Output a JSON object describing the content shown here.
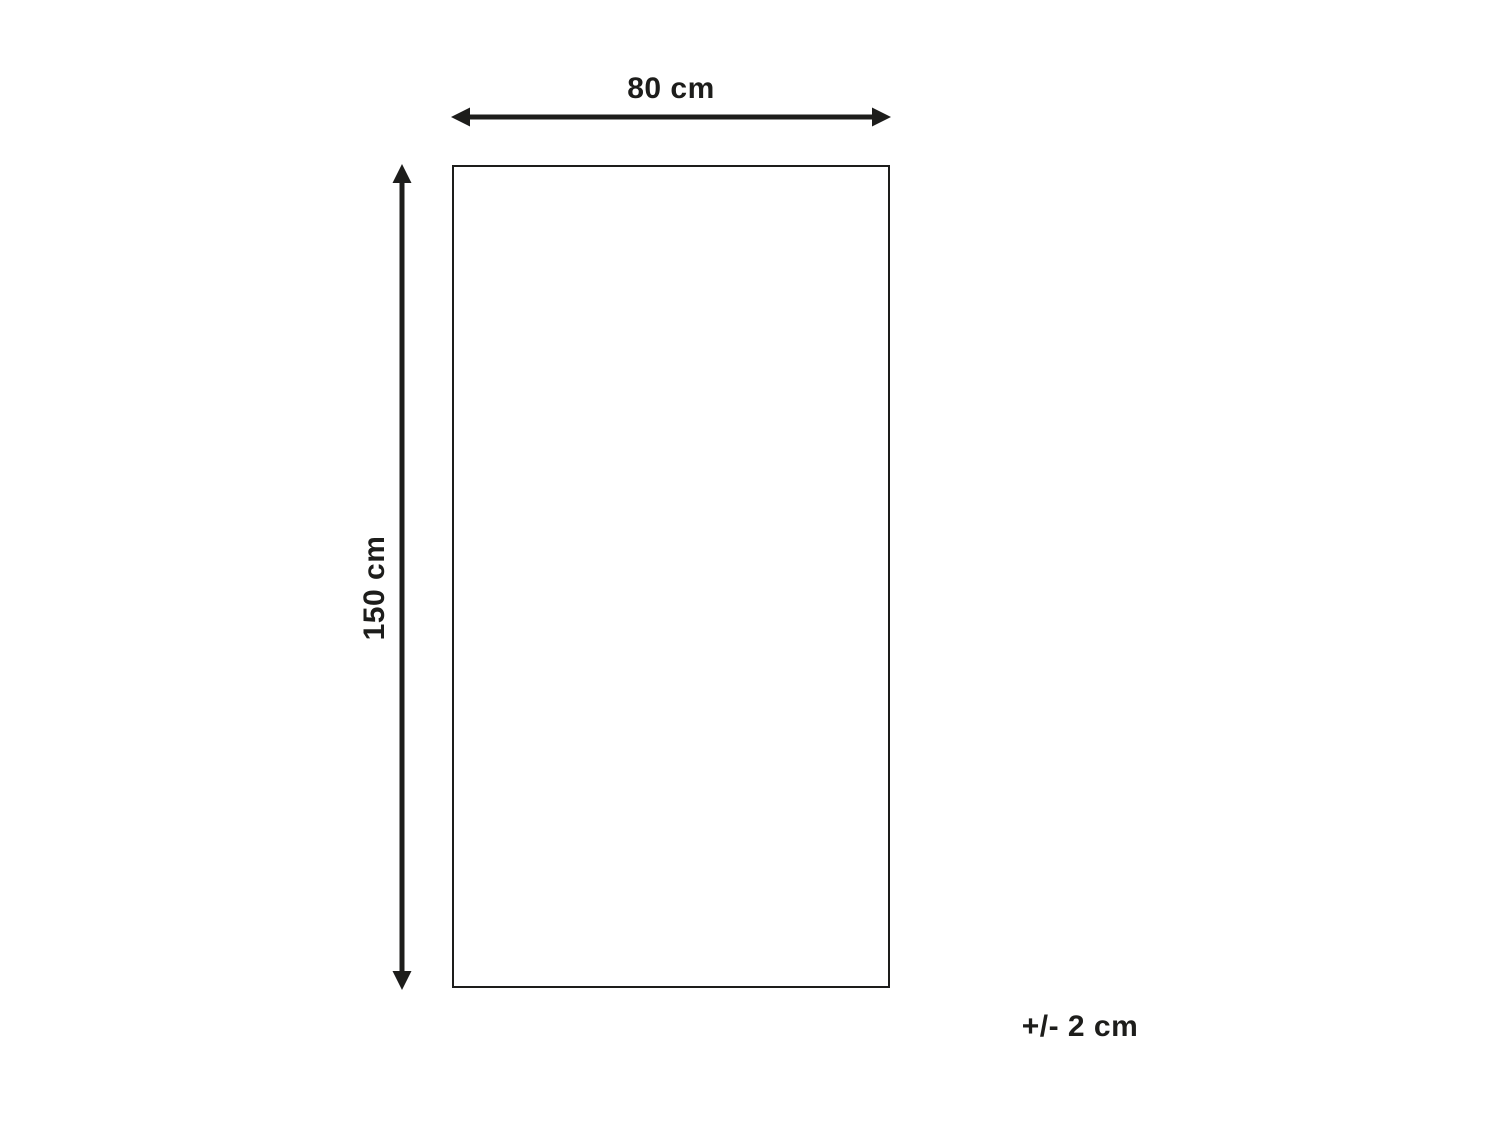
{
  "diagram": {
    "width_label": "80 cm",
    "height_label": "150 cm",
    "tolerance_label": "+/- 2 cm",
    "line_color": "#1d1d1b",
    "background_color": "#ffffff"
  }
}
